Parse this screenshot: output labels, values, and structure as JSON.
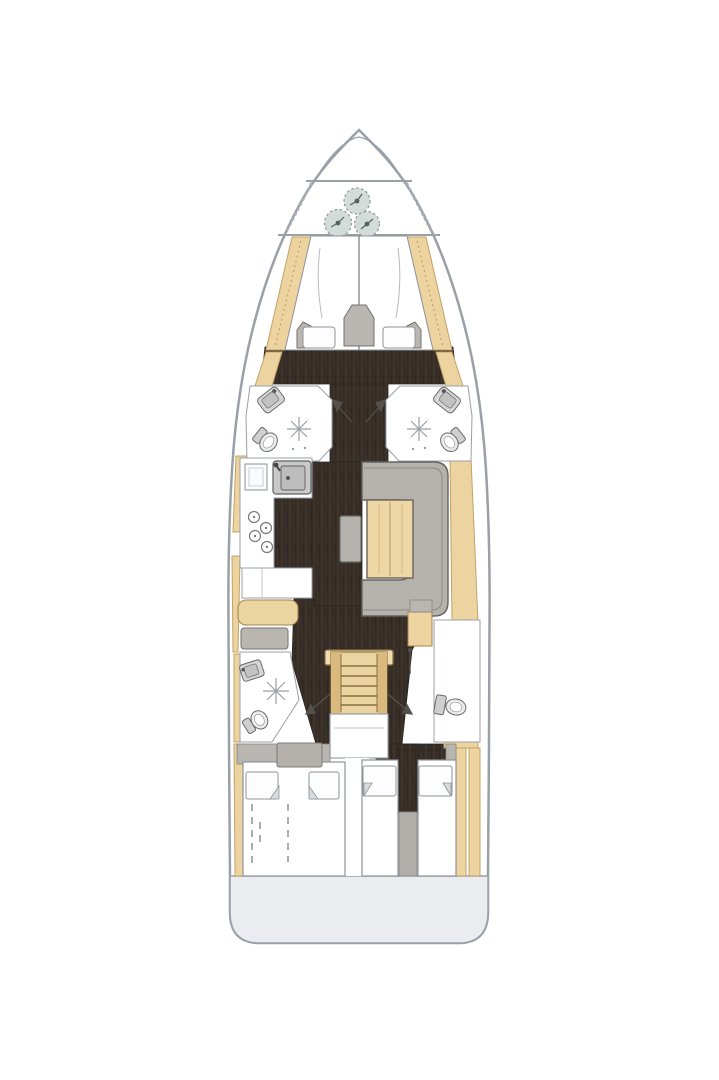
{
  "diagram": {
    "type": "yacht-floor-plan",
    "subject": "Sailing yacht interior layout, top-down view",
    "orientation_bow": "top",
    "orientation_stern": "bottom"
  },
  "rooms": {
    "anchor_locker": {
      "name": "Anchor locker (bow tip)"
    },
    "sail_locker": {
      "name": "Bow stowage locker with rope coils"
    },
    "forward_cabin": {
      "name": "Forward owner cabin with V-berth"
    },
    "head_fwd_port": {
      "name": "Forward port head with shower, sink and WC"
    },
    "head_fwd_stbd": {
      "name": "Forward starboard head with shower, sink and WC"
    },
    "galley": {
      "name": "Galley with sink, refrigerator and stove"
    },
    "salon": {
      "name": "Salon with U-shaped sofa and table"
    },
    "nav_station": {
      "name": "Navigation station with chart table and seat"
    },
    "head_aft_port": {
      "name": "Aft port head with shower, sink and WC"
    },
    "head_aft_stbd": {
      "name": "Aft starboard head with WC"
    },
    "companionway": {
      "name": "Companionway stairs"
    },
    "engine": {
      "name": "Engine compartment box"
    },
    "aft_cabin_port": {
      "name": "Aft port cabin with double berth"
    },
    "aft_cabin_stbd": {
      "name": "Aft starboard cabin with double berth"
    },
    "transom": {
      "name": "Transom swim platform"
    }
  },
  "features": {
    "rope_coils": 3,
    "shower_stalls": 3,
    "toilets": 4,
    "sinks": 4,
    "stove_burners": 4,
    "berths": 3,
    "door_swing_arrows": 4
  },
  "colors": {
    "background": "#ffffff",
    "hull_outline": "#9aa0a8",
    "hull_fill": "#ffffff",
    "deck_wood": "#ecd3a0",
    "deck_wood_edge": "#c2a368",
    "floor_dark": "#362d26",
    "floor_grain": "#51453a",
    "room_outline": "#9aa0a8",
    "room_fill": "#ffffff",
    "upholstery_gray": "#b5b1ad",
    "upholstery_edge": "#6f6c68",
    "table_wood": "#eed7a6",
    "table_edge": "#6b6257",
    "stairs_wood": "#ead49f",
    "stairs_shade": "#d9b97c",
    "stairs_edge": "#8a6f45",
    "fixture_fill": "#d6d6d6",
    "fixture_inner": "#c2c2c2",
    "fixture_edge": "#6a6a6a",
    "locker_item_fill": "#d3dcd8",
    "locker_item_edge": "#8e9894",
    "bulkhead_gray": "#b9b6b2",
    "bulkhead_edge": "#8a8783",
    "bed_outline": "#8e9399",
    "arrow_color": "#55504b",
    "transom_fill": "#eaecf0"
  }
}
